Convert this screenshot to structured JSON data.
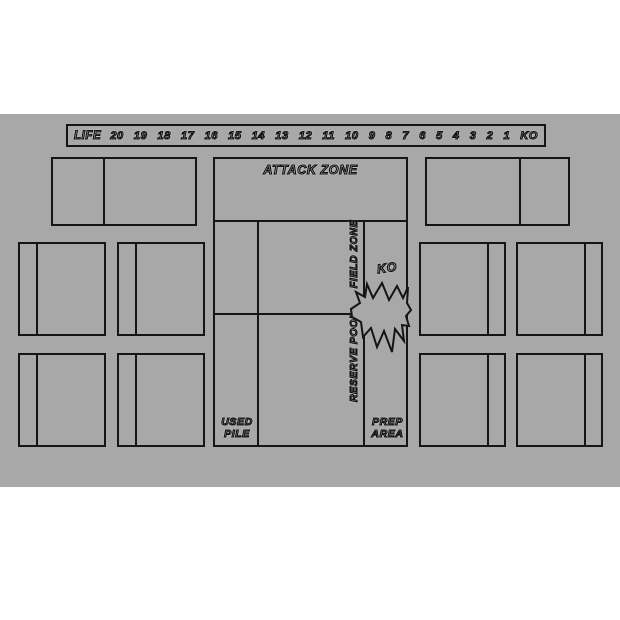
{
  "colors": {
    "page_background": "#ffffff",
    "mat_background": "#a8a8a8",
    "line_color": "#151515"
  },
  "life_track": {
    "label": "LIFE",
    "values": [
      "20",
      "19",
      "18",
      "17",
      "16",
      "15",
      "14",
      "13",
      "12",
      "11",
      "10",
      "9",
      "8",
      "7",
      "6",
      "5",
      "4",
      "3",
      "2",
      "1",
      "KO"
    ]
  },
  "zones": {
    "attack_zone": "ATTACK ZONE",
    "field_zone": "FIELD ZONE",
    "ko": "KO",
    "reserve_pool": "RESERVE POOL",
    "used_pile": {
      "line1": "USED",
      "line2": "PILE"
    },
    "prep_area": {
      "line1": "PREP",
      "line2": "AREA"
    }
  },
  "icons": {
    "burst": "explosion-burst-icon"
  }
}
